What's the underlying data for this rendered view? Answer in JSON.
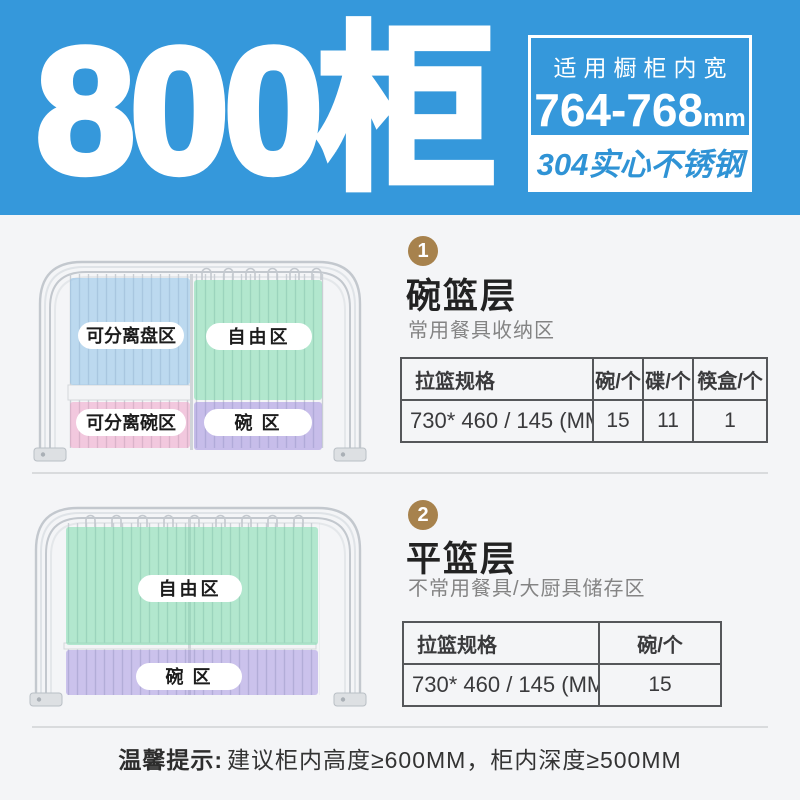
{
  "colors": {
    "header-bg": "#3598db",
    "header-text": "#ffffff",
    "strip-bg": "#ffffff",
    "strip-text": "#2f93d5",
    "badge-gold": "#a7824d",
    "body-bg": "#f4f5f7",
    "divider": "#d9dbdd",
    "table-border": "#55575a",
    "title-text": "#222222",
    "subtitle-text": "#848484",
    "tip-text": "#333333"
  },
  "header": {
    "title": "800柜",
    "spec_label": "适用橱柜内宽",
    "spec_value": "764-768",
    "spec_unit": "mm",
    "material_badge": "304实心不锈钢"
  },
  "sections": [
    {
      "number": "1",
      "title": "碗篮层",
      "subtitle": "常用餐具收纳区",
      "zones": [
        {
          "label": "可分离盘区",
          "color": "#8ec1ea"
        },
        {
          "label": "自由区",
          "color": "#6fd9a6"
        },
        {
          "label": "可分离碗区",
          "color": "#f092bf"
        },
        {
          "label": "碗 区",
          "color": "#9a86dd"
        }
      ],
      "table": {
        "headers": [
          "拉篮规格",
          "碗/个",
          "碟/个",
          "筷盒/个"
        ],
        "rows": [
          [
            "730* 460 / 145 (MM)",
            "15",
            "11",
            "1"
          ]
        ]
      }
    },
    {
      "number": "2",
      "title": "平篮层",
      "subtitle": "不常用餐具/大厨具储存区",
      "zones": [
        {
          "label": "自由区",
          "color": "#6fd9a6"
        },
        {
          "label": "碗 区",
          "color": "#9a86dd"
        }
      ],
      "table": {
        "headers": [
          "拉篮规格",
          "碗/个"
        ],
        "rows": [
          [
            "730* 460 / 145 (MM)",
            "15"
          ]
        ]
      }
    }
  ],
  "footer": {
    "tip_label": "温馨提示:",
    "tip_text": "建议柜内高度≥600MM，柜内深度≥500MM"
  }
}
